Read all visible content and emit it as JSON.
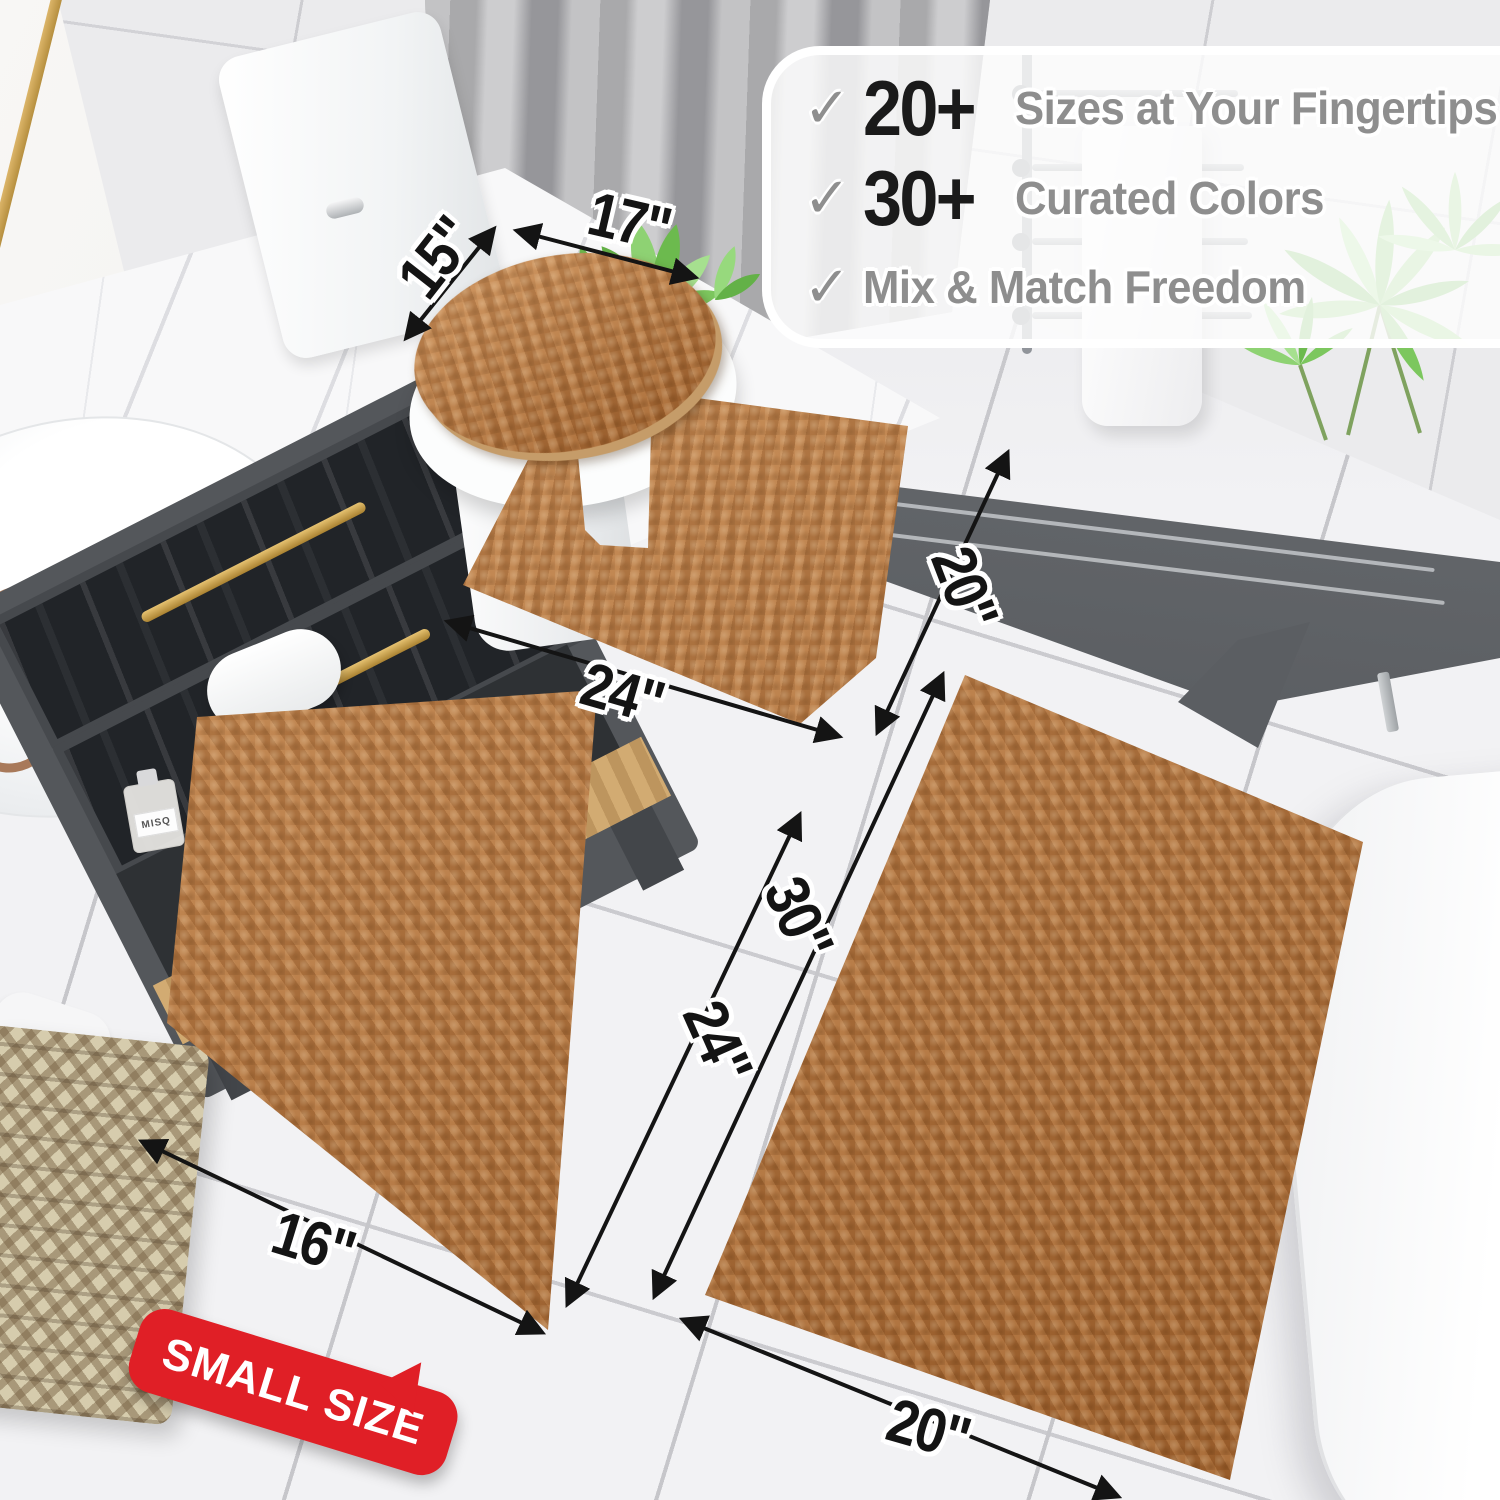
{
  "callout": {
    "items": [
      {
        "check": "✓",
        "stat": "20+",
        "label": "Sizes at Your Fingertips"
      },
      {
        "check": "✓",
        "stat": "30+",
        "label": "Curated Colors"
      },
      {
        "check": "✓",
        "stat": "",
        "label": "Mix & Match Freedom"
      }
    ]
  },
  "measurements": {
    "lid_width": "15\"",
    "lid_depth": "17\"",
    "contour_width": "24\"",
    "contour_depth": "20\"",
    "small_rug_width": "16\"",
    "small_rug_length": "24\"",
    "large_rug_length": "30\"",
    "large_rug_width": "20\""
  },
  "badge": {
    "label": "SMALL SIZE"
  },
  "decor": {
    "bottle_label": "MISQ"
  },
  "colors": {
    "rug": "#b4713a",
    "rug-dark": "#8a5426",
    "badge": "#e01f26",
    "stat": "#1a1a1a",
    "muted": "#8e8e8e",
    "arrow": "#141414"
  }
}
